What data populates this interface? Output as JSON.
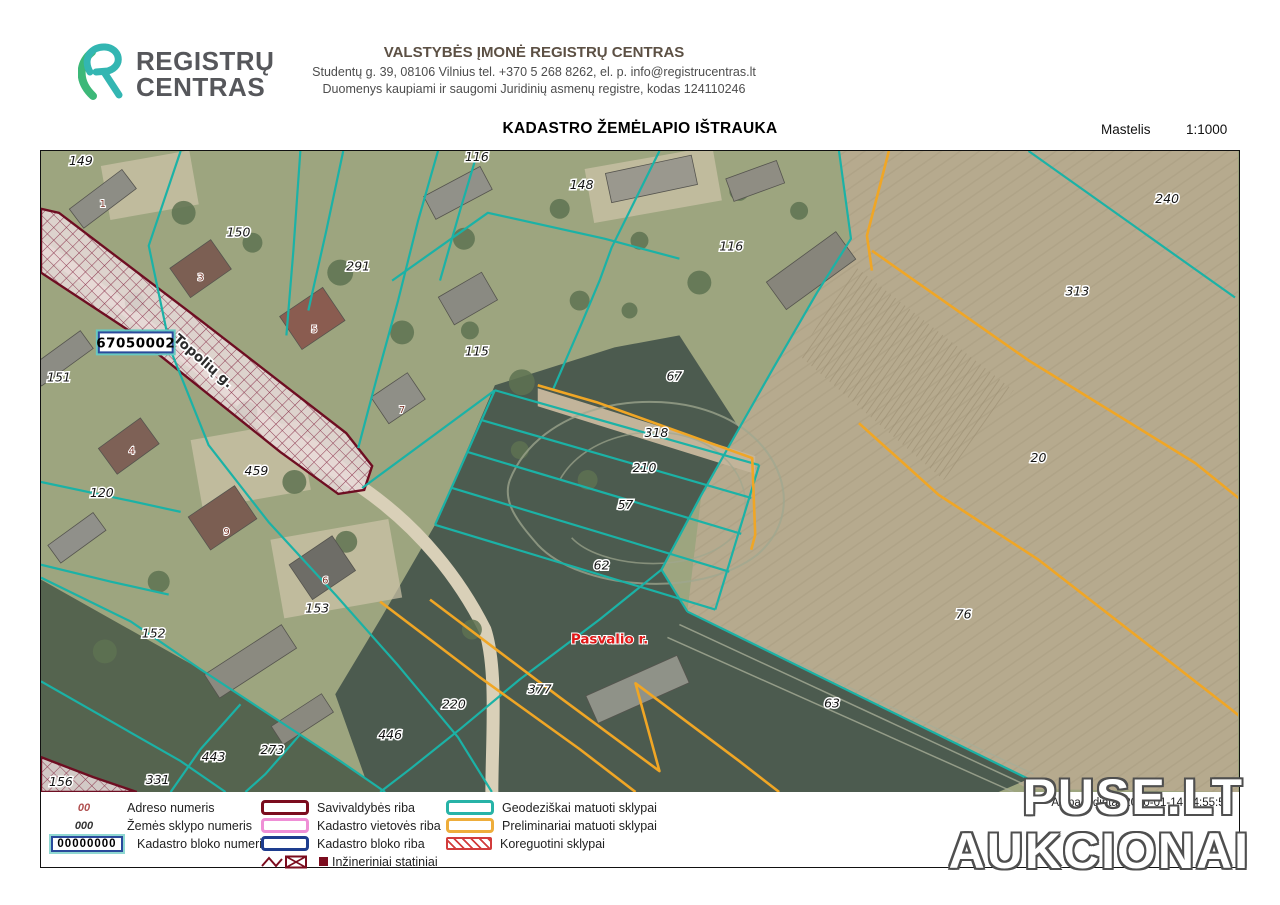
{
  "header": {
    "logo": {
      "line1": "REGISTRŲ",
      "line2": "CENTRAS"
    },
    "org_name": "VALSTYBĖS ĮMONĖ REGISTRŲ CENTRAS",
    "org_address": "Studentų g. 39, 08106 Vilnius tel. +370 5 268 8262,  el. p. info@registrucentras.lt",
    "org_register": "Duomenys kaupiami ir saugomi Juridinių asmenų registre, kodas 124110246"
  },
  "title": {
    "text": "KADASTRO ŽEMĖLAPIO IŠTRAUKA",
    "scale_label": "Mastelis",
    "scale_value": "1:1000"
  },
  "footer": {
    "printed_text": "Atspausdinta: 2020-01-14 14:55:55"
  },
  "watermark": {
    "line1": "PUSE.LT",
    "line2": "AUKCIONAI"
  },
  "colors": {
    "geodetic": "#1bb2a6",
    "preliminary": "#f0a625",
    "municipality": "#7b0c1e",
    "locality": "#ef8fd6",
    "block": "#1e3d8f",
    "correction": "#d23c3c",
    "district_text": "#e01818",
    "label_text": "#141414",
    "building_text": "#7d3a2e"
  },
  "legend": {
    "samples": [
      {
        "sample": "00",
        "label": "Adreso numeris",
        "style": "address"
      },
      {
        "sample": "000",
        "label": "Žemės sklypo numeris",
        "style": "parcel"
      },
      {
        "sample": "00000000",
        "label": "Kadastro bloko numeris",
        "style": "block"
      }
    ],
    "boundary_items": [
      {
        "label": "Savivaldybės riba",
        "color": "#7b0c1e",
        "type": "swatch"
      },
      {
        "label": "Kadastro vietovės riba",
        "color": "#ef8fd6",
        "type": "swatch"
      },
      {
        "label": "Kadastro bloko riba",
        "color": "#1e3d8f",
        "type": "swatch"
      },
      {
        "label": "Inžineriniai statiniai",
        "color": "#7b0c1e",
        "type": "engineering"
      }
    ],
    "parcel_items": [
      {
        "label": "Geodeziškai matuoti sklypai",
        "color": "#27b3a7",
        "type": "swatch"
      },
      {
        "label": "Preliminariai matuoti sklypai",
        "color": "#eead3b",
        "type": "swatch"
      },
      {
        "label": "Koreguotini sklypai",
        "color": "#d23c3c",
        "type": "hatch"
      }
    ]
  },
  "map": {
    "block_number": "67050002",
    "street_label": "Topolių g.",
    "district_label": "Pasvalio r.",
    "parcel_labels": [
      {
        "t": "149",
        "x": 40,
        "y": 14
      },
      {
        "t": "150",
        "x": 198,
        "y": 86
      },
      {
        "t": "291",
        "x": 318,
        "y": 120
      },
      {
        "t": "116",
        "x": 437,
        "y": 10
      },
      {
        "t": "148",
        "x": 542,
        "y": 38
      },
      {
        "t": "116",
        "x": 692,
        "y": 100
      },
      {
        "t": "115",
        "x": 437,
        "y": 205
      },
      {
        "t": "67",
        "x": 635,
        "y": 230
      },
      {
        "t": "151",
        "x": 18,
        "y": 231
      },
      {
        "t": "120",
        "x": 61,
        "y": 347
      },
      {
        "t": "459",
        "x": 216,
        "y": 325
      },
      {
        "t": "153",
        "x": 277,
        "y": 463
      },
      {
        "t": "152",
        "x": 113,
        "y": 488
      },
      {
        "t": "156",
        "x": 20,
        "y": 637
      },
      {
        "t": "331",
        "x": 117,
        "y": 635
      },
      {
        "t": "443",
        "x": 173,
        "y": 612
      },
      {
        "t": "273",
        "x": 232,
        "y": 605
      },
      {
        "t": "446",
        "x": 350,
        "y": 590
      },
      {
        "t": "220",
        "x": 414,
        "y": 559
      },
      {
        "t": "377",
        "x": 500,
        "y": 544
      },
      {
        "t": "318",
        "x": 617,
        "y": 287
      },
      {
        "t": "210",
        "x": 605,
        "y": 322
      },
      {
        "t": "57",
        "x": 586,
        "y": 359
      },
      {
        "t": "62",
        "x": 562,
        "y": 420
      },
      {
        "t": "63",
        "x": 793,
        "y": 558
      },
      {
        "t": "76",
        "x": 925,
        "y": 469
      },
      {
        "t": "240",
        "x": 1129,
        "y": 52
      },
      {
        "t": "313",
        "x": 1039,
        "y": 145
      },
      {
        "t": "20",
        "x": 1000,
        "y": 312
      }
    ],
    "building_labels": [
      {
        "t": "1",
        "x": 62,
        "y": 56
      },
      {
        "t": "3",
        "x": 160,
        "y": 130
      },
      {
        "t": "5",
        "x": 274,
        "y": 182
      },
      {
        "t": "7",
        "x": 362,
        "y": 263
      },
      {
        "t": "4",
        "x": 91,
        "y": 304
      },
      {
        "t": "9",
        "x": 186,
        "y": 385
      },
      {
        "t": "6",
        "x": 285,
        "y": 434
      }
    ],
    "geodetic_lines": [
      [
        [
          140,
          0
        ],
        [
          108,
          95
        ],
        [
          130,
          200
        ],
        [
          168,
          295
        ],
        [
          228,
          372
        ],
        [
          296,
          446
        ],
        [
          358,
          516
        ],
        [
          418,
          588
        ],
        [
          452,
          643
        ]
      ],
      [
        [
          260,
          0
        ],
        [
          253,
          100
        ],
        [
          246,
          185
        ]
      ],
      [
        [
          303,
          0
        ],
        [
          286,
          80
        ],
        [
          268,
          160
        ]
      ],
      [
        [
          398,
          0
        ],
        [
          378,
          70
        ],
        [
          358,
          150
        ],
        [
          336,
          230
        ],
        [
          318,
          298
        ]
      ],
      [
        [
          438,
          0
        ],
        [
          420,
          60
        ],
        [
          400,
          130
        ]
      ],
      [
        [
          620,
          0
        ],
        [
          572,
          97
        ],
        [
          560,
          130
        ],
        [
          542,
          173
        ],
        [
          513,
          240
        ]
      ],
      [
        [
          352,
          130
        ],
        [
          448,
          62
        ],
        [
          565,
          88
        ],
        [
          640,
          108
        ]
      ],
      [
        [
          800,
          0
        ],
        [
          812,
          88
        ],
        [
          778,
          142
        ],
        [
          734,
          218
        ],
        [
          700,
          278
        ],
        [
          662,
          345
        ],
        [
          622,
          420
        ],
        [
          648,
          462
        ]
      ],
      [
        [
          648,
          462
        ],
        [
          990,
          630
        ]
      ],
      [
        [
          622,
          420
        ],
        [
          560,
          470
        ],
        [
          480,
          530
        ],
        [
          420,
          580
        ],
        [
          370,
          620
        ],
        [
          340,
          643
        ]
      ],
      [
        [
          455,
          240
        ],
        [
          720,
          315
        ]
      ],
      [
        [
          442,
          270
        ],
        [
          712,
          348
        ]
      ],
      [
        [
          428,
          302
        ],
        [
          702,
          384
        ]
      ],
      [
        [
          412,
          338
        ],
        [
          690,
          422
        ]
      ],
      [
        [
          395,
          375
        ],
        [
          676,
          460
        ]
      ],
      [
        [
          720,
          315
        ],
        [
          676,
          460
        ]
      ],
      [
        [
          322,
          338
        ],
        [
          455,
          240
        ]
      ],
      [
        [
          395,
          375
        ],
        [
          455,
          240
        ]
      ],
      [
        [
          0,
          332
        ],
        [
          85,
          350
        ],
        [
          140,
          362
        ]
      ],
      [
        [
          0,
          415
        ],
        [
          70,
          432
        ],
        [
          128,
          445
        ]
      ],
      [
        [
          0,
          428
        ],
        [
          90,
          472
        ],
        [
          160,
          520
        ],
        [
          230,
          566
        ],
        [
          300,
          612
        ],
        [
          345,
          643
        ]
      ],
      [
        [
          0,
          532
        ],
        [
          70,
          572
        ],
        [
          140,
          612
        ],
        [
          185,
          643
        ]
      ],
      [
        [
          200,
          555
        ],
        [
          160,
          600
        ],
        [
          130,
          643
        ]
      ],
      [
        [
          260,
          585
        ],
        [
          225,
          625
        ],
        [
          205,
          643
        ]
      ],
      [
        [
          990,
          0
        ],
        [
          1197,
          147
        ]
      ]
    ],
    "preliminary_lines": [
      [
        [
          850,
          0
        ],
        [
          828,
          85
        ],
        [
          833,
          120
        ]
      ],
      [
        [
          833,
          100
        ],
        [
          990,
          210
        ],
        [
          1157,
          313
        ],
        [
          1240,
          380
        ]
      ],
      [
        [
          820,
          273
        ],
        [
          900,
          345
        ],
        [
          1000,
          410
        ],
        [
          1193,
          560
        ],
        [
          1240,
          598
        ]
      ],
      [
        [
          498,
          235
        ],
        [
          557,
          252
        ],
        [
          713,
          308
        ],
        [
          716,
          385
        ],
        [
          712,
          400
        ]
      ],
      [
        [
          340,
          452
        ],
        [
          440,
          528
        ],
        [
          540,
          600
        ],
        [
          596,
          643
        ]
      ],
      [
        [
          390,
          450
        ],
        [
          520,
          548
        ],
        [
          620,
          622
        ],
        [
          596,
          534
        ],
        [
          700,
          612
        ],
        [
          740,
          643
        ]
      ]
    ],
    "corridor_outline": [
      [
        0,
        58
      ],
      [
        18,
        62
      ],
      [
        160,
        170
      ],
      [
        306,
        283
      ],
      [
        332,
        316
      ],
      [
        324,
        340
      ],
      [
        298,
        344
      ],
      [
        240,
        302
      ],
      [
        88,
        180
      ],
      [
        0,
        122
      ]
    ],
    "corridor_wedge": [
      [
        0,
        608
      ],
      [
        52,
        628
      ],
      [
        96,
        643
      ],
      [
        0,
        643
      ]
    ],
    "terrain": {
      "tan_field": [
        [
          800,
          0
        ],
        [
          1200,
          0
        ],
        [
          1200,
          643
        ],
        [
          990,
          640
        ],
        [
          648,
          462
        ],
        [
          662,
          345
        ],
        [
          734,
          218
        ],
        [
          778,
          142
        ],
        [
          812,
          88
        ]
      ],
      "dark_field": [
        [
          455,
          235
        ],
        [
          575,
          197
        ],
        [
          640,
          185
        ],
        [
          700,
          278
        ],
        [
          662,
          345
        ],
        [
          622,
          420
        ],
        [
          648,
          462
        ],
        [
          990,
          630
        ],
        [
          960,
          643
        ],
        [
          330,
          643
        ],
        [
          295,
          545
        ],
        [
          340,
          470
        ],
        [
          395,
          375
        ]
      ],
      "dark_field2": [
        [
          0,
          430
        ],
        [
          160,
          520
        ],
        [
          300,
          612
        ],
        [
          345,
          643
        ],
        [
          0,
          643
        ]
      ],
      "tan_band": [
        [
          498,
          238
        ],
        [
          716,
          306
        ],
        [
          716,
          324
        ],
        [
          498,
          256
        ]
      ],
      "garden_rows": [
        [
          815,
          115
        ],
        [
          975,
          240
        ],
        [
          905,
          330
        ],
        [
          760,
          205
        ]
      ]
    },
    "buildings": [
      [
        62,
        48,
        66,
        24,
        -37,
        "#8d8d85"
      ],
      [
        160,
        118,
        50,
        36,
        -35,
        "#7c5f53"
      ],
      [
        272,
        168,
        52,
        40,
        -34,
        "#8a5c50"
      ],
      [
        358,
        248,
        44,
        32,
        -34,
        "#8f8f87"
      ],
      [
        418,
        42,
        64,
        26,
        -28,
        "#919189"
      ],
      [
        428,
        148,
        50,
        32,
        -30,
        "#8a8a82"
      ],
      [
        612,
        28,
        88,
        30,
        -12,
        "#9a988e"
      ],
      [
        716,
        30,
        54,
        24,
        -20,
        "#8f8d83"
      ],
      [
        772,
        120,
        86,
        34,
        -36,
        "#87857b"
      ],
      [
        88,
        296,
        52,
        32,
        -36,
        "#7e6156"
      ],
      [
        20,
        208,
        64,
        22,
        -36,
        "#8c8c84"
      ],
      [
        182,
        368,
        56,
        40,
        -34,
        "#7b5e52"
      ],
      [
        282,
        418,
        52,
        42,
        -34,
        "#6e6d67"
      ],
      [
        210,
        512,
        92,
        28,
        -33,
        "#8b8a80"
      ],
      [
        36,
        388,
        56,
        22,
        -36,
        "#90908a"
      ],
      [
        598,
        540,
        100,
        30,
        -24,
        "#8f9288"
      ],
      [
        262,
        570,
        60,
        22,
        -33,
        "#8a897f"
      ]
    ],
    "trees": [
      [
        143,
        62,
        12
      ],
      [
        212,
        92,
        10
      ],
      [
        300,
        122,
        13
      ],
      [
        424,
        88,
        11
      ],
      [
        520,
        58,
        10
      ],
      [
        362,
        182,
        12
      ],
      [
        482,
        232,
        13
      ],
      [
        206,
        262,
        11
      ],
      [
        94,
        152,
        10
      ],
      [
        254,
        332,
        12
      ],
      [
        306,
        392,
        11
      ],
      [
        548,
        330,
        10
      ],
      [
        432,
        480,
        10
      ],
      [
        118,
        432,
        11
      ],
      [
        64,
        502,
        12
      ],
      [
        660,
        132,
        12
      ],
      [
        700,
        40,
        10
      ],
      [
        600,
        90,
        9
      ],
      [
        760,
        60,
        9
      ],
      [
        540,
        150,
        10
      ],
      [
        590,
        160,
        8
      ],
      [
        480,
        300,
        9
      ],
      [
        430,
        180,
        9
      ]
    ]
  }
}
